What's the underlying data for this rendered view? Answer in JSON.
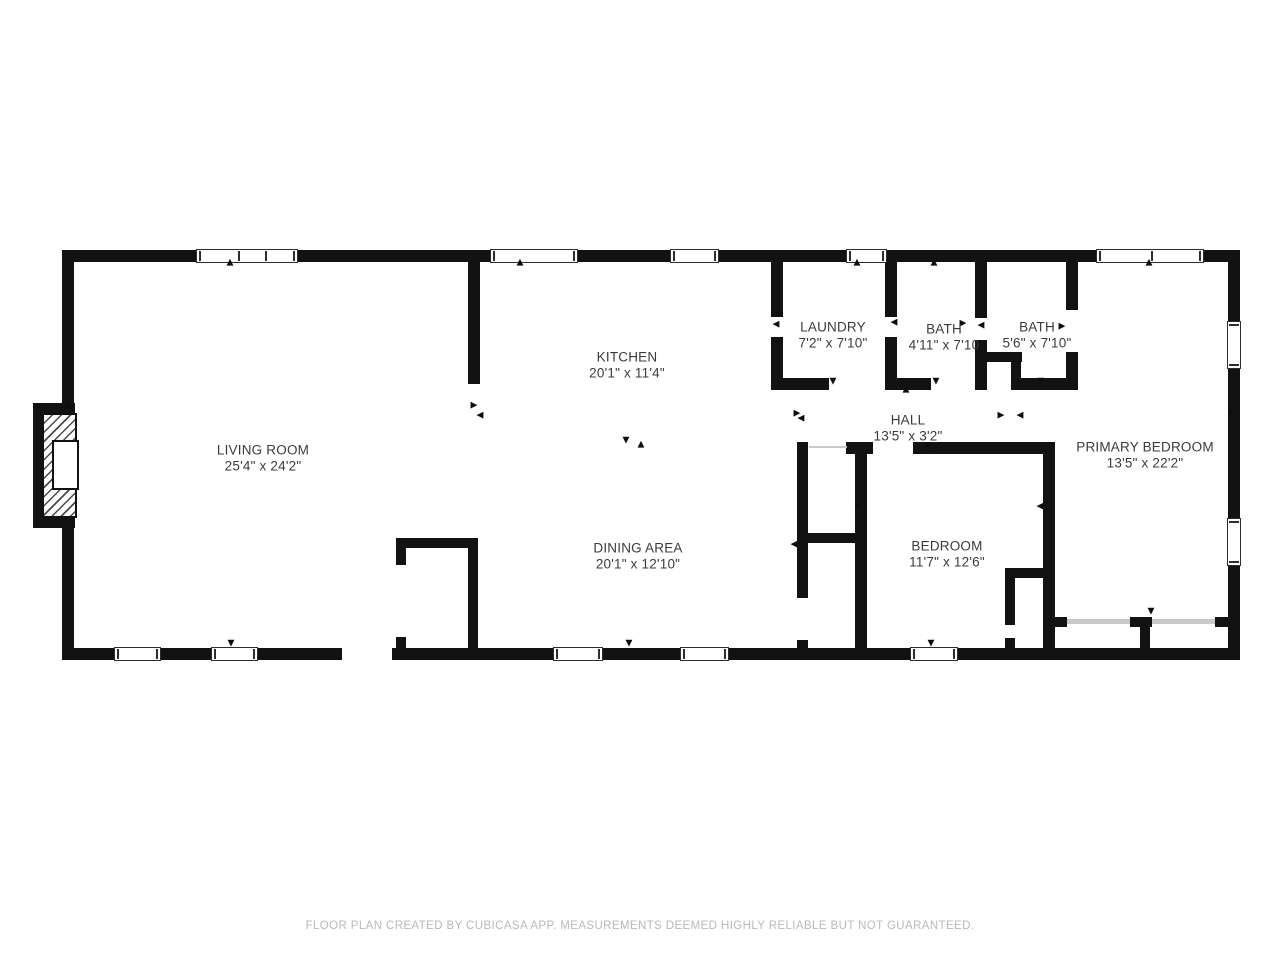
{
  "footer": {
    "text": "FLOOR PLAN CREATED BY CUBICASA APP. MEASUREMENTS DEEMED HIGHLY RELIABLE BUT NOT GUARANTEED."
  },
  "colors": {
    "wall": "#121212",
    "label": "#3b3b3b",
    "footer_text": "#b9b9b9",
    "window_frame": "#2d2d2d",
    "slider_track": "#c8c8c8",
    "background": "#ffffff"
  },
  "floorplan": {
    "rooms": [
      {
        "name": "LIVING ROOM",
        "dims": "25'4\" x 24'2\"",
        "cx": 263,
        "cy": 458
      },
      {
        "name": "KITCHEN",
        "dims": "20'1\" x 11'4\"",
        "cx": 627,
        "cy": 365
      },
      {
        "name": "LAUNDRY",
        "dims": "7'2\" x 7'10\"",
        "cx": 833,
        "cy": 335
      },
      {
        "name": "BATH",
        "dims": "4'11\" x 7'10",
        "cx": 944,
        "cy": 337
      },
      {
        "name": "BATH",
        "dims": "5'6\" x 7'10\"",
        "cx": 1037,
        "cy": 335
      },
      {
        "name": "HALL",
        "dims": "13'5\" x 3'2\"",
        "cx": 908,
        "cy": 428
      },
      {
        "name": "PRIMARY BEDROOM",
        "dims": "13'5\" x 22'2\"",
        "cx": 1145,
        "cy": 455
      },
      {
        "name": "DINING AREA",
        "dims": "20'1\" x 12'10\"",
        "cx": 638,
        "cy": 556
      },
      {
        "name": "BEDROOM",
        "dims": "11'7\" x 12'6\"",
        "cx": 947,
        "cy": 554
      }
    ],
    "walls": [
      [
        62,
        250,
        1178,
        12
      ],
      [
        62,
        648,
        1178,
        12
      ],
      [
        62,
        250,
        12,
        160
      ],
      [
        62,
        521,
        12,
        139
      ],
      [
        1228,
        250,
        12,
        410
      ],
      [
        33,
        403,
        42,
        12
      ],
      [
        33,
        516,
        42,
        12
      ],
      [
        33,
        403,
        9,
        125
      ],
      [
        468,
        262,
        12,
        122
      ],
      [
        771,
        262,
        12,
        55
      ],
      [
        771,
        337,
        12,
        53
      ],
      [
        885,
        262,
        12,
        55
      ],
      [
        885,
        337,
        12,
        53
      ],
      [
        975,
        262,
        12,
        56
      ],
      [
        975,
        340,
        12,
        50
      ],
      [
        1066,
        262,
        12,
        48
      ],
      [
        1066,
        352,
        12,
        38
      ],
      [
        980,
        352,
        42,
        10
      ],
      [
        1011,
        352,
        10,
        38
      ],
      [
        771,
        378,
        58,
        12
      ],
      [
        885,
        378,
        46,
        12
      ],
      [
        975,
        378,
        12,
        12
      ],
      [
        1013,
        378,
        65,
        12
      ],
      [
        846,
        442,
        27,
        12
      ],
      [
        913,
        442,
        142,
        12
      ],
      [
        855,
        454,
        12,
        194
      ],
      [
        1043,
        454,
        12,
        194
      ],
      [
        797,
        442,
        11,
        156
      ],
      [
        797,
        640,
        11,
        8
      ],
      [
        797,
        533,
        58,
        10
      ],
      [
        396,
        538,
        82,
        10
      ],
      [
        396,
        548,
        10,
        17
      ],
      [
        396,
        637,
        10,
        11
      ],
      [
        468,
        538,
        10,
        110
      ],
      [
        1005,
        568,
        48,
        10
      ],
      [
        1005,
        578,
        10,
        47
      ],
      [
        1005,
        638,
        10,
        10
      ],
      [
        1053,
        617,
        14,
        10
      ],
      [
        1130,
        617,
        22,
        10
      ],
      [
        1215,
        617,
        25,
        10
      ],
      [
        1140,
        627,
        10,
        21
      ]
    ],
    "windows": [
      {
        "x": 196,
        "y": 249,
        "w": 102,
        "h": 14,
        "orient": "h",
        "mullions": [
          41,
          68
        ]
      },
      {
        "x": 490,
        "y": 249,
        "w": 88,
        "h": 14,
        "orient": "h",
        "mullions": []
      },
      {
        "x": 670,
        "y": 249,
        "w": 49,
        "h": 14,
        "orient": "h",
        "mullions": []
      },
      {
        "x": 846,
        "y": 249,
        "w": 41,
        "h": 14,
        "orient": "h",
        "mullions": []
      },
      {
        "x": 1096,
        "y": 249,
        "w": 108,
        "h": 14,
        "orient": "h",
        "mullions": [
          54
        ]
      },
      {
        "x": 114,
        "y": 647,
        "w": 47,
        "h": 14,
        "orient": "h",
        "mullions": []
      },
      {
        "x": 211,
        "y": 647,
        "w": 47,
        "h": 14,
        "orient": "h",
        "mullions": []
      },
      {
        "x": 553,
        "y": 647,
        "w": 50,
        "h": 14,
        "orient": "h",
        "mullions": []
      },
      {
        "x": 680,
        "y": 647,
        "w": 49,
        "h": 14,
        "orient": "h",
        "mullions": []
      },
      {
        "x": 910,
        "y": 647,
        "w": 48,
        "h": 14,
        "orient": "h",
        "mullions": []
      },
      {
        "x": 1227,
        "y": 321,
        "w": 14,
        "h": 48,
        "orient": "v",
        "mullions": []
      },
      {
        "x": 1227,
        "y": 518,
        "w": 14,
        "h": 48,
        "orient": "v",
        "mullions": []
      }
    ],
    "door_gaps": [
      [
        342,
        648,
        50,
        12
      ]
    ],
    "slider_tracks": [
      [
        1067,
        619,
        63,
        5
      ],
      [
        1152,
        619,
        63,
        5
      ],
      [
        809,
        446,
        38,
        2
      ]
    ],
    "fireplace": {
      "hatch": [
        42,
        413,
        35,
        105
      ],
      "firebox": [
        52,
        440,
        27,
        50
      ]
    },
    "markers": [
      {
        "x": 230,
        "y": 263,
        "g": "▲"
      },
      {
        "x": 520,
        "y": 263,
        "g": "▲"
      },
      {
        "x": 857,
        "y": 263,
        "g": "▲"
      },
      {
        "x": 934,
        "y": 263,
        "g": "▲"
      },
      {
        "x": 1149,
        "y": 263,
        "g": "▲"
      },
      {
        "x": 906,
        "y": 390,
        "g": "▲"
      },
      {
        "x": 641,
        "y": 445,
        "g": "▲"
      },
      {
        "x": 231,
        "y": 644,
        "g": "▼"
      },
      {
        "x": 629,
        "y": 644,
        "g": "▼"
      },
      {
        "x": 931,
        "y": 644,
        "g": "▼"
      },
      {
        "x": 626,
        "y": 441,
        "g": "▼"
      },
      {
        "x": 833,
        "y": 382,
        "g": "▼"
      },
      {
        "x": 936,
        "y": 382,
        "g": "▼"
      },
      {
        "x": 1041,
        "y": 382,
        "g": "▼"
      },
      {
        "x": 929,
        "y": 447,
        "g": "▼"
      },
      {
        "x": 1151,
        "y": 612,
        "g": "▼"
      },
      {
        "x": 66,
        "y": 407,
        "g": "◀"
      },
      {
        "x": 480,
        "y": 416,
        "g": "◀"
      },
      {
        "x": 776,
        "y": 325,
        "g": "◀"
      },
      {
        "x": 894,
        "y": 323,
        "g": "◀"
      },
      {
        "x": 981,
        "y": 326,
        "g": "◀"
      },
      {
        "x": 1020,
        "y": 416,
        "g": "◀"
      },
      {
        "x": 794,
        "y": 545,
        "g": "◀"
      },
      {
        "x": 1040,
        "y": 507,
        "g": "◀"
      },
      {
        "x": 801,
        "y": 419,
        "g": "◀"
      },
      {
        "x": 474,
        "y": 406,
        "g": "▶"
      },
      {
        "x": 963,
        "y": 324,
        "g": "▶"
      },
      {
        "x": 1062,
        "y": 327,
        "g": "▶"
      },
      {
        "x": 1001,
        "y": 416,
        "g": "▶"
      },
      {
        "x": 859,
        "y": 507,
        "g": "▶"
      },
      {
        "x": 797,
        "y": 414,
        "g": "▶"
      },
      {
        "x": 1232,
        "y": 413,
        "g": "▶"
      }
    ]
  }
}
